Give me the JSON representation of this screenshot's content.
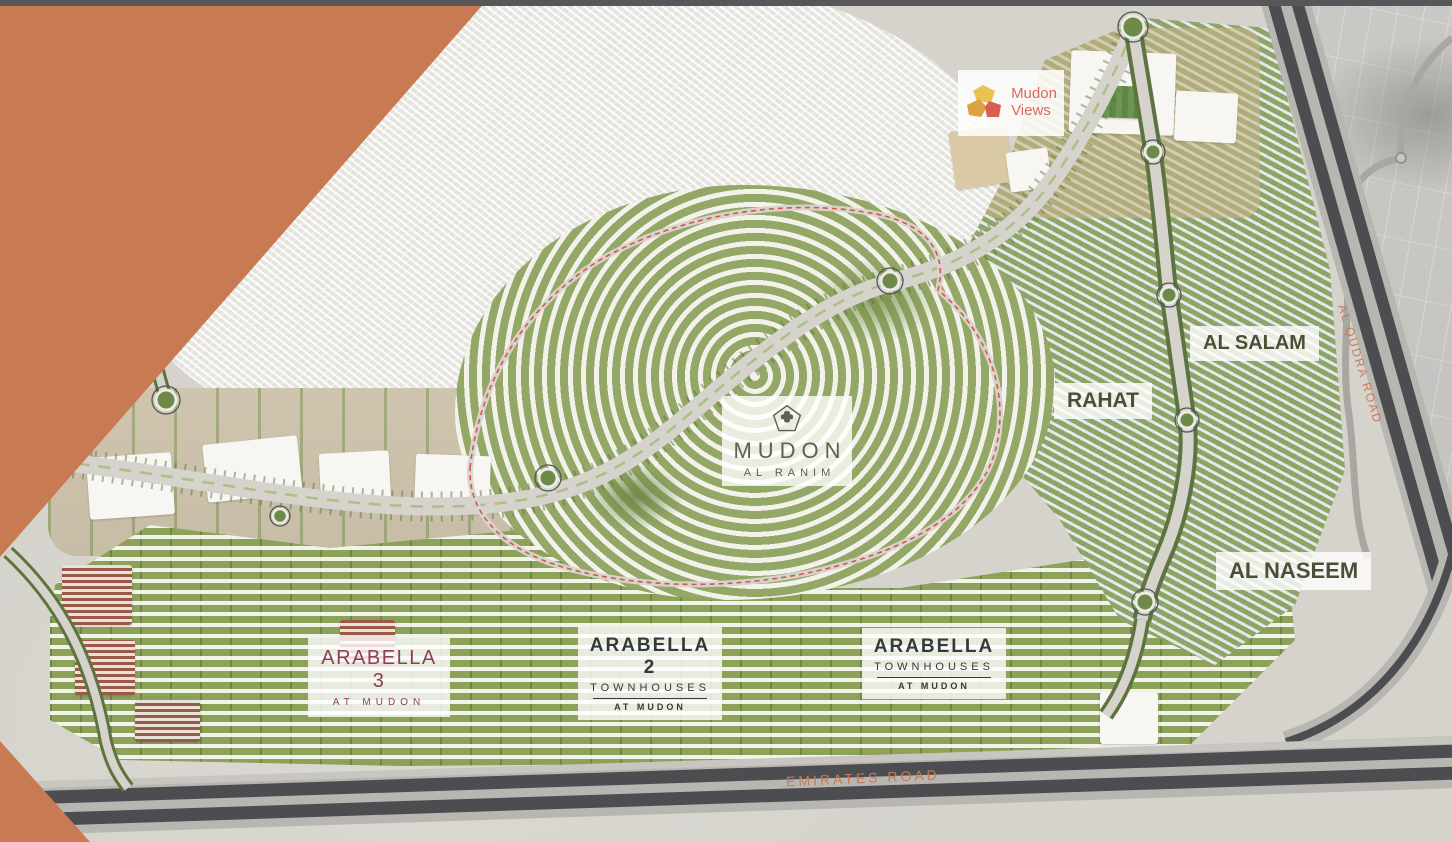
{
  "colors": {
    "orange_overlay": "#c87a53",
    "top_bar": "#57575a",
    "desert": "#d6d3cd",
    "development_green": "#8fa563",
    "road_dark": "#4b4d51",
    "label_olive": "#5c6150",
    "community_label": "#4a5038",
    "arabella3_maroon": "#8c3f53",
    "arabella_dark": "#36393c",
    "road_label_orange": "#c97a55",
    "mudon_views_red": "#d96a60",
    "logo_yellow": "#e9c351",
    "logo_orange": "#dda23f",
    "logo_red": "#d95d53"
  },
  "labels": {
    "mudon_views": {
      "line1": "Mudon",
      "line2": "Views"
    },
    "mudon_al_ranim": {
      "name": "MUDON",
      "subname": "AL RANIM"
    },
    "rahat": "RAHAT",
    "al_salam": "AL SALAM",
    "al_naseem": "AL NASEEM",
    "arabella_3": {
      "name": "ARABELLA 3",
      "subtitle": "AT MUDON"
    },
    "arabella_2": {
      "name": "ARABELLA 2",
      "type": "TOWNHOUSES",
      "subtitle": "AT MUDON"
    },
    "arabella": {
      "name": "ARABELLA",
      "type": "TOWNHOUSES",
      "subtitle": "AT MUDON"
    }
  },
  "roads": {
    "emirates": "EMIRATES ROAD",
    "al_qudra": "AL QUDRA ROAD"
  }
}
